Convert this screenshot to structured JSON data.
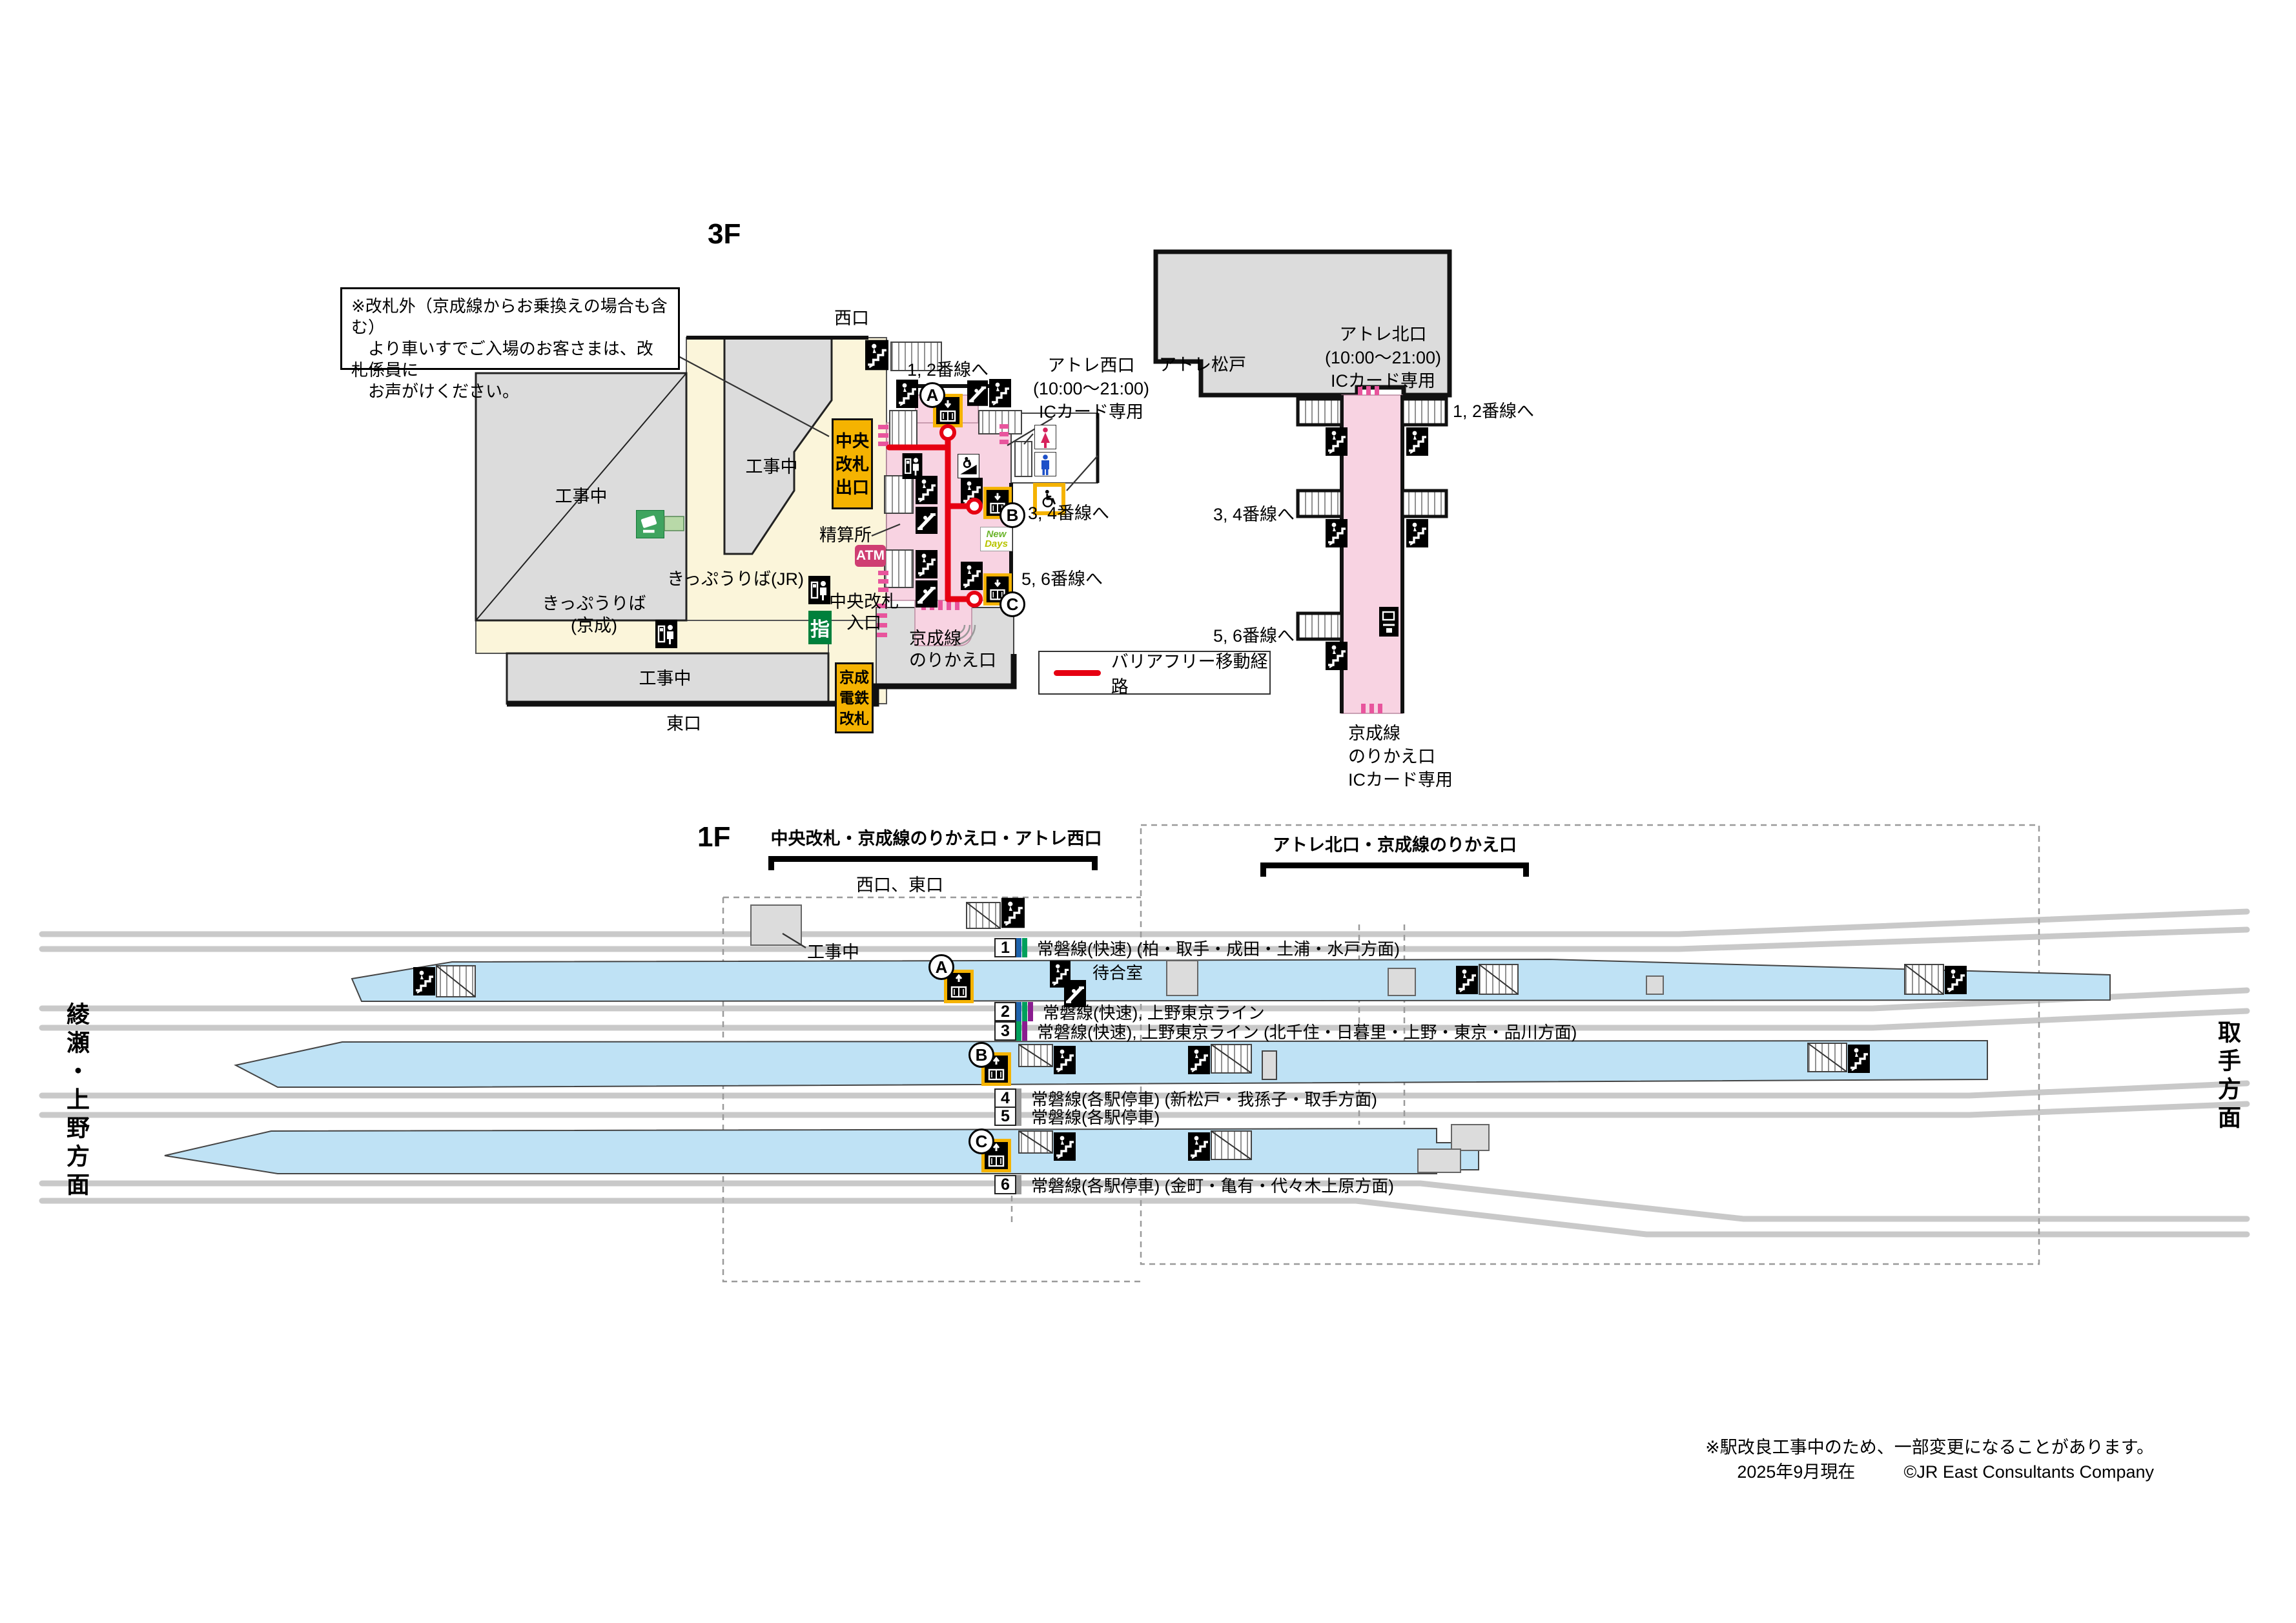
{
  "station": {
    "floor3_title": "3F",
    "floor1_title": "1F",
    "note": "※改札外（京成線からお乗換えの場合も含む）\n　より車いすでご入場のお客さまは、改札係員に\n　お声がけください。"
  },
  "floor3": {
    "west_exit": "西口",
    "east_exit": "東口",
    "under_construction": "工事中",
    "central_gate_exit": "中央\n改札\n出口",
    "fare_adjustment": "精算所",
    "ticket_office_jr": "きっぷうりば(JR)",
    "ticket_office_keisei": "きっぷうりば\n(京成)",
    "central_gate_entrance": "中央改札\n入口",
    "atm": "ATM",
    "reserved_seat": "指",
    "keisei_gate": "京成\n電鉄\n改札",
    "keisei_transfer": "京成線\nのりかえ口",
    "keisei_transfer_ic": "京成線\nのりかえ口\nICカード専用",
    "atre_matsudo": "アトレ松戸",
    "atre_west": "アトレ西口\n(10:00〜21:00)\nICカード専用",
    "atre_north": "アトレ北口\n(10:00〜21:00)\nICカード専用",
    "to_tracks_12": "1, 2番線へ",
    "to_tracks_34": "3, 4番線へ",
    "to_tracks_56": "5, 6番線へ",
    "newdays_line1": "New",
    "newdays_line2": "Days",
    "legend_barrier_free": "バリアフリー移動経路"
  },
  "elevators": [
    "A",
    "B",
    "C"
  ],
  "floor1": {
    "bracket_left": "中央改札・京成線のりかえ口・アトレ西口",
    "bracket_right": "アトレ北口・京成線のりかえ口",
    "exits_west_east": "西口、東口",
    "under_construction": "工事中",
    "waiting_room": "待合室",
    "platforms": [
      {
        "num": "1",
        "stripes": [
          "blue",
          "green"
        ],
        "label": "常磐線(快速) (柏・取手・成田・土浦・水戸方面)"
      },
      {
        "num": "2",
        "stripes": [
          "blue",
          "green",
          "purple"
        ],
        "label": "常磐線(快速), 上野東京ライン"
      },
      {
        "num": "3",
        "stripes": [
          "green",
          "purple"
        ],
        "label": "常磐線(快速), 上野東京ライン (北千住・日暮里・上野・東京・品川方面)"
      },
      {
        "num": "4",
        "stripes": [
          "gray"
        ],
        "label": "常磐線(各駅停車) (新松戸・我孫子・取手方面)"
      },
      {
        "num": "5",
        "stripes": [
          "gray"
        ],
        "label": "常磐線(各駅停車)"
      },
      {
        "num": "6",
        "stripes": [
          "gray"
        ],
        "label": "常磐線(各駅停車) (金町・亀有・代々木上原方面)"
      }
    ],
    "direction_left": "綾瀬・上野方面",
    "direction_right": "取手方面"
  },
  "footer": {
    "note": "※駅改良工事中のため、一部変更になることがあります。",
    "date": "2025年9月現在",
    "credit": "©JR East Consultants Company"
  },
  "colors": {
    "stripes": {
      "blue": "#1d63ad",
      "green": "#00a05c",
      "purple": "#8a1d8f",
      "gray": "#9b9b9b"
    },
    "pink_zone": "#f8d3e2",
    "cream_zone": "#fbf5da",
    "gray_zone": "#dcdcdc",
    "platform_blue": "#bfe2f5",
    "accent_yellow": "#f5b301",
    "route_red": "#e60012",
    "gate_pink": "#e8559d"
  }
}
